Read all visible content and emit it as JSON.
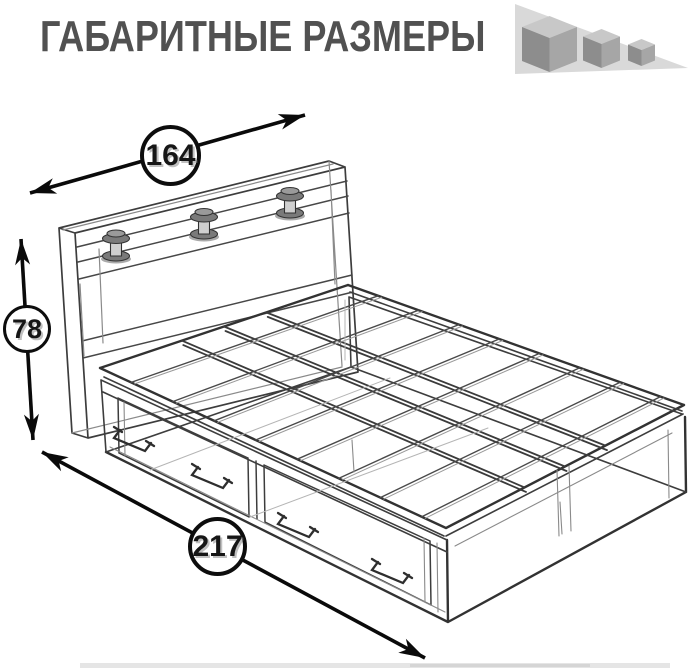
{
  "header": {
    "title": "ГАБАРИТНЫЕ РАЗМЕРЫ"
  },
  "diagram": {
    "subject": "bed with storage drawers — wireframe technical drawing",
    "dimensions": {
      "width": "164",
      "height": "78",
      "length": "217"
    }
  },
  "icons": {
    "size_cubes": "three-shrinking-cubes-icon"
  },
  "colors": {
    "title_text": "#515151",
    "drawing_line": "#3e3e3e",
    "arrow": "#0a0a0a",
    "cube_top": "#c8c8c8",
    "cube_left": "#8d8d8d",
    "cube_right": "#a6a6a6",
    "triangle_backdrop": "#d9d9d9"
  }
}
